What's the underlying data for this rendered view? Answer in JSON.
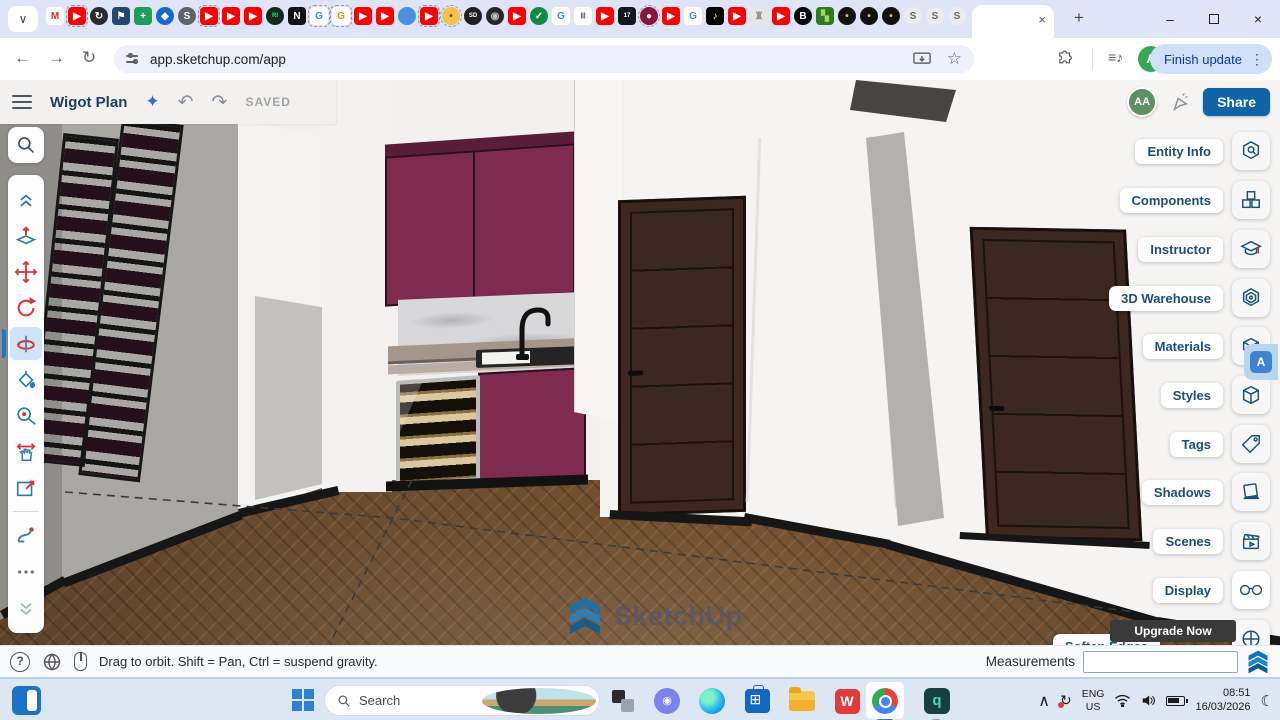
{
  "browser": {
    "tab_chevron": "∨",
    "pinned_tabs": [
      {
        "t": "square",
        "bg": "#ffffff",
        "fg": "#d93025",
        "g": "M"
      },
      {
        "t": "square",
        "bg": "#ff0000",
        "fg": "#ffffff",
        "g": "▶",
        "d": 1
      },
      {
        "t": "circle",
        "bg": "#2b2b2b",
        "fg": "#ffffff",
        "g": "↻"
      },
      {
        "t": "square",
        "bg": "#24476f",
        "fg": "#ffffff",
        "g": "⚑"
      },
      {
        "t": "square",
        "bg": "#1e9e5a",
        "fg": "#ffffff",
        "g": "+"
      },
      {
        "t": "circle",
        "bg": "#1b66c9",
        "fg": "#ffffff",
        "g": "◆"
      },
      {
        "t": "circle",
        "bg": "#5f6368",
        "fg": "#ffffff",
        "g": "S"
      },
      {
        "t": "square",
        "bg": "#ff0000",
        "fg": "#ffffff",
        "g": "▶",
        "d": 1
      },
      {
        "t": "square",
        "bg": "#ff0000",
        "fg": "#ffffff",
        "g": "▶"
      },
      {
        "t": "square",
        "bg": "#ff0000",
        "fg": "#ffffff",
        "g": "▶"
      },
      {
        "t": "circle",
        "bg": "#0d2b1e",
        "fg": "#41d98d",
        "g": "RI"
      },
      {
        "t": "square",
        "bg": "#111111",
        "fg": "#ffffff",
        "g": "N"
      },
      {
        "t": "square",
        "bg": "#ffffff",
        "fg": "#4285f4",
        "g": "G",
        "d": 1
      },
      {
        "t": "square",
        "bg": "#ffffff",
        "fg": "#ea8600",
        "g": "G",
        "d": 1
      },
      {
        "t": "square",
        "bg": "#ff0000",
        "fg": "#ffffff",
        "g": "▶"
      },
      {
        "t": "square",
        "bg": "#ff0000",
        "fg": "#ffffff",
        "g": "▶"
      },
      {
        "t": "circle",
        "bg": "#4a8fe0",
        "fg": "#cfe3fa",
        "g": ""
      },
      {
        "t": "square",
        "bg": "#ff0000",
        "fg": "#ffffff",
        "g": "▶",
        "d": 1
      },
      {
        "t": "circle",
        "bg": "#f2c14e",
        "fg": "#6b4e00",
        "g": "•",
        "d": 1
      },
      {
        "t": "circle",
        "bg": "#1f1f1f",
        "fg": "#ffffff",
        "g": "SD"
      },
      {
        "t": "circle",
        "bg": "#262626",
        "fg": "#bbbbbb",
        "g": "◉"
      },
      {
        "t": "square",
        "bg": "#ff0000",
        "fg": "#ffffff",
        "g": "▶"
      },
      {
        "t": "circle",
        "bg": "#0d8a44",
        "fg": "#ffffff",
        "g": "✓"
      },
      {
        "t": "square",
        "bg": "#ffffff",
        "fg": "#4285f4",
        "g": "G"
      },
      {
        "t": "square",
        "bg": "#ffffff",
        "fg": "#333333",
        "g": "|||"
      },
      {
        "t": "square",
        "bg": "#ff0000",
        "fg": "#ffffff",
        "g": "▶"
      },
      {
        "t": "square",
        "bg": "#131722",
        "fg": "#ffffff",
        "g": "17"
      },
      {
        "t": "circle",
        "bg": "#8a1538",
        "fg": "#ffffff",
        "g": "●",
        "d": 1
      },
      {
        "t": "square",
        "bg": "#ff0000",
        "fg": "#ffffff",
        "g": "▶"
      },
      {
        "t": "square",
        "bg": "#ffffff",
        "fg": "#4285f4",
        "g": "G"
      },
      {
        "t": "square",
        "bg": "#000000",
        "fg": "#ffffff",
        "g": "♪"
      },
      {
        "t": "square",
        "bg": "#ff0000",
        "fg": "#ffffff",
        "g": "▶"
      },
      {
        "t": "square",
        "bg": "#e8e6e3",
        "fg": "#9a958e",
        "g": "♜"
      },
      {
        "t": "square",
        "bg": "#ff0000",
        "fg": "#ffffff",
        "g": "▶"
      },
      {
        "t": "circle",
        "bg": "#000000",
        "fg": "#ffffff",
        "g": "B"
      },
      {
        "t": "square",
        "bg": "#2d7a1f",
        "fg": "#9fd86a",
        "g": "▚"
      },
      {
        "t": "circle",
        "bg": "#111111",
        "fg": "#f5c518",
        "g": "•"
      },
      {
        "t": "circle",
        "bg": "#111111",
        "fg": "#f5c518",
        "g": "•"
      },
      {
        "t": "circle",
        "bg": "#111111",
        "fg": "#f5c518",
        "g": "•"
      },
      {
        "t": "circle",
        "bg": "#ececec",
        "fg": "#666666",
        "g": "S"
      },
      {
        "t": "circle",
        "bg": "#ececec",
        "fg": "#666666",
        "g": "S"
      },
      {
        "t": "circle",
        "bg": "#ececec",
        "fg": "#666666",
        "g": "S"
      }
    ],
    "active_tab_close": "×",
    "new_tab": "+",
    "minimize": "–",
    "close": "×",
    "back": "←",
    "forward": "→",
    "reload": "↻",
    "url": "app.sketchup.com/app",
    "bookmark_star": "☆",
    "media_icon": "≡♪",
    "profile_initial": "A",
    "update_button": "Finish update",
    "kebab": "⋮"
  },
  "app": {
    "title": "Wigot Plan",
    "sparkle": "✦",
    "undo": "↶",
    "redo": "↷",
    "saved_label": "SAVED",
    "avatar_initials": "AA",
    "share_label": "Share",
    "panels": [
      "Entity Info",
      "Components",
      "Instructor",
      "3D Warehouse",
      "Materials",
      "Styles",
      "Tags",
      "Shadows",
      "Scenes",
      "Display"
    ],
    "upgrade_label": "Upgrade Now",
    "partial_panel_label": "Soften Edges",
    "watermark": "SketchUp",
    "status_hint": "Drag to orbit. Shift = Pan, Ctrl = suspend gravity.",
    "measurements_label": "Measurements",
    "measurements_value": "",
    "help_glyph": "?",
    "accent_blue": "#1e4e79",
    "share_blue": "#0f63a6",
    "cabinet_maroon": "#7f2b4f"
  },
  "taskbar": {
    "search_placeholder": "Search",
    "store_glyph": "",
    "wps_glyph": "W",
    "q_glyph": "q",
    "chat_glyph": "◉",
    "tray_chevron": "∧",
    "sync_glyph": "↻",
    "language_line1": "ENG",
    "language_line2": "US",
    "time": "08:51",
    "date": "16/03/2026",
    "moon": "☾"
  }
}
